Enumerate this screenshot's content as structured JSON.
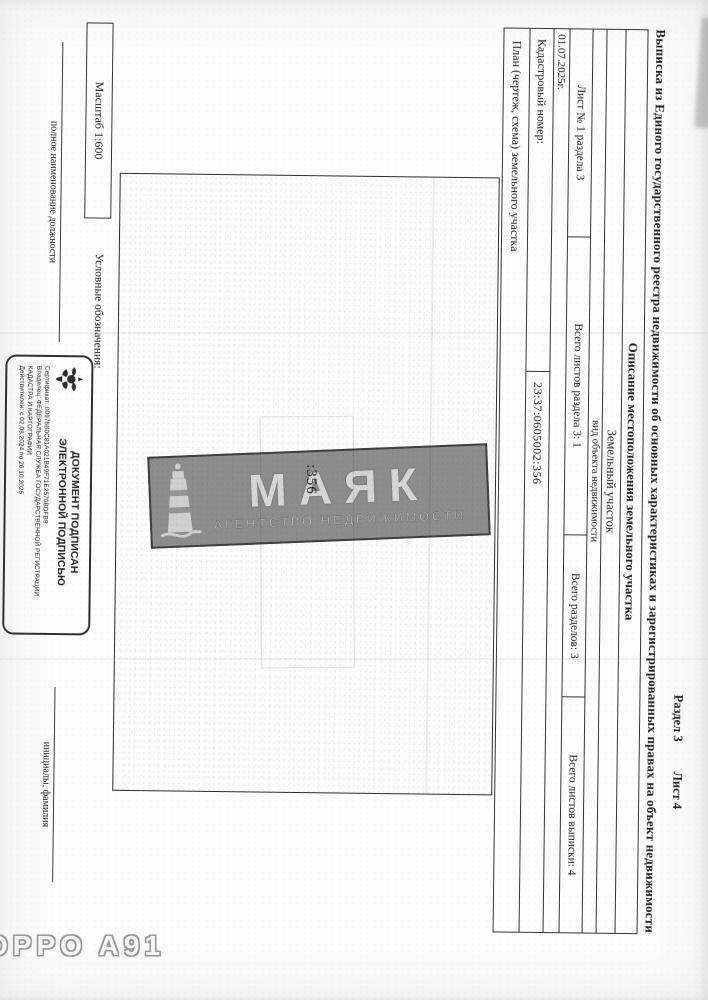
{
  "photo": {
    "camera_watermark": "OPPO A91",
    "agency_watermark": {
      "name": "МАЯК",
      "subtitle": "АГЕНТСТВО НЕДВИЖИМОСТИ",
      "box_color": "#8f8f8f"
    }
  },
  "document": {
    "corner": {
      "section": "Раздел 3",
      "sheet": "Лист 4"
    },
    "title": "Выписка из Единого государственного реестра недвижимости об основных характеристиках и зарегистрированных правах на объект недвижимости",
    "section_description": "Описание местоположения земельного участка",
    "object_kind": {
      "value": "Земельный участок",
      "label": "вид объекта недвижимости"
    },
    "sheet_info": {
      "cells": [
        "Лист № 1 раздела 3",
        "Всего листов раздела 3: 1",
        "Всего разделов: 3",
        "Всего листов выписки: 4"
      ]
    },
    "date": "01.07.2025г.",
    "cadastral": {
      "label": "Кадастровый номер:",
      "value": "23:37:0605002:356"
    },
    "plan": {
      "caption": "План (чертеж, схема) земельного участка",
      "parcel_label": ":356",
      "scale": "Масштаб 1:600",
      "legend_label": "Условные обозначения:"
    },
    "signature": {
      "position_label": "полное наименование должности",
      "initials_label": "инициалы, фамилия",
      "stamp": {
        "title_line1": "ДОКУМЕНТ ПОДПИСАН",
        "title_line2": "ЭЛЕКТРОННОЙ ПОДПИСЬЮ",
        "certificate": "Сертификат: 00976B0C81A021B49F71E2570BDFB9",
        "owner": "Владелец: ФЕДЕРАЛЬНАЯ СЛУЖБА ГОСУДАРСТВЕННОЙ РЕГИСТРАЦИИ, КАДАСТРА И КАРТОГРАФИИ",
        "validity": "Действителен: с 02.08.2024 по 26.10.2025"
      }
    }
  },
  "colors": {
    "ink": "#1f1f1f",
    "watermark_box": "#8f8f8f",
    "border": "#343434"
  }
}
